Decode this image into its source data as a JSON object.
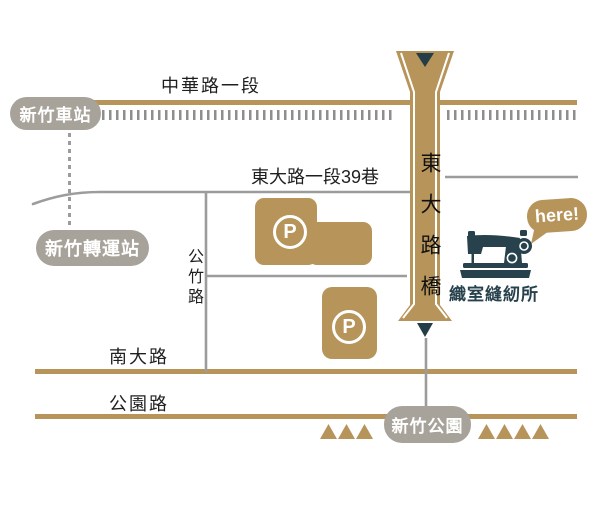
{
  "roads": {
    "zhonghua": {
      "label": "中華路一段"
    },
    "dongda_lane": {
      "label": "東大路一段39巷"
    },
    "gongzhu": {
      "label": "公竹路"
    },
    "nanda": {
      "label": "南大路"
    },
    "gongyuan": {
      "label": "公園路"
    },
    "bridge": {
      "label": "東大路橋"
    }
  },
  "places": {
    "train_station": {
      "label": "新竹車站"
    },
    "bus_terminal": {
      "label": "新竹轉運站"
    },
    "park": {
      "label": "新竹公園"
    }
  },
  "parking": {
    "label": "P"
  },
  "destination": {
    "bubble": "here!",
    "name": "織室縫紉所"
  },
  "colors": {
    "road_tan": "#b79459",
    "navy": "#27424c",
    "badge_gray": "#a8a39a",
    "minor_road_gray": "#9c9c9c",
    "rail_gray": "#8e8e8e",
    "text": "#1f1f1f"
  }
}
